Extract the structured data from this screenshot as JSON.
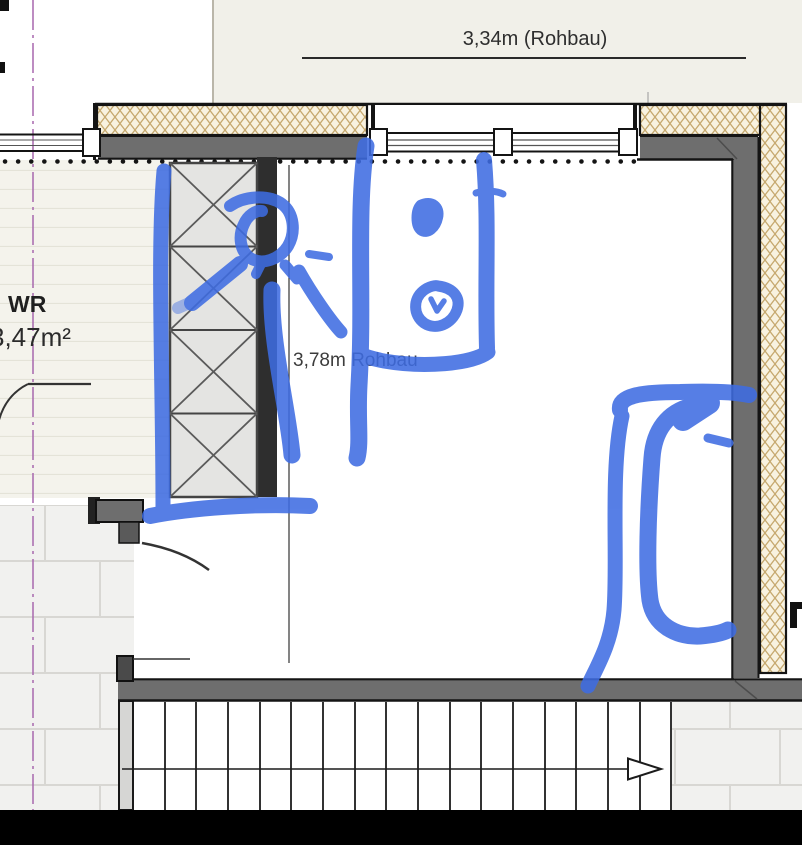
{
  "title": "Floor plan detail with blue marker annotations",
  "labels": {
    "top_dimension": "3,34m (Rohbau)",
    "room_depth_dimension": "3,78m Rohbau",
    "room_name": "WR",
    "room_area": "3,47m²"
  },
  "colors": {
    "annotation_blue": "#3e6ce2",
    "wall_gray": "#6e6e6e",
    "insulation_line_tan": "#c6a96f",
    "insulation_bg": "#f8f2e0",
    "centerline_purple": "#aa6bb0",
    "paper_beige": "#f1f0e9",
    "letterbox_black": "#000000"
  }
}
